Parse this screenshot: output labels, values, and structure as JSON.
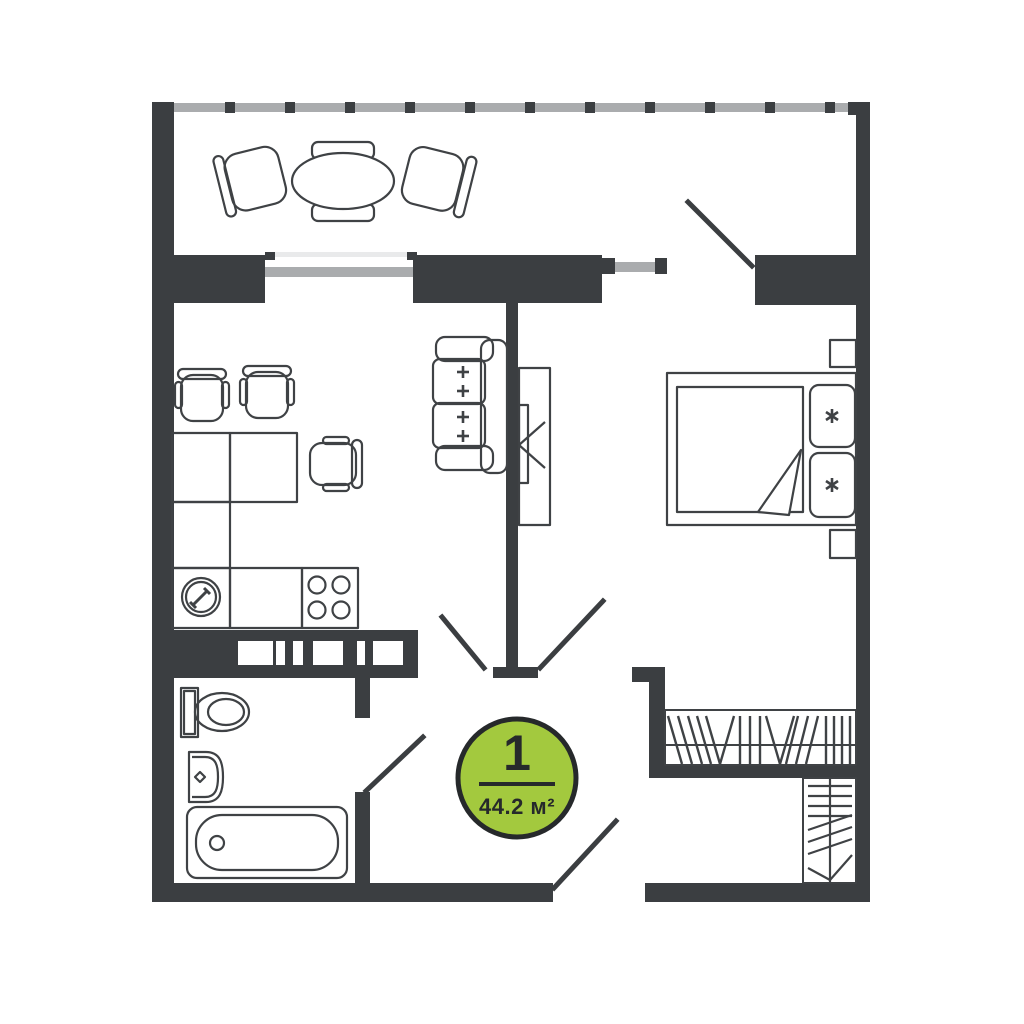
{
  "badge": {
    "number": "1",
    "area": "44.2 м²"
  },
  "colors": {
    "background": "#ffffff",
    "wall": "#3b3e41",
    "line": "#3f4245",
    "glazing": "#aaacae",
    "sill": "#e9eaeb",
    "badge_fill": "#a3c93e",
    "badge_stroke": "#26292b",
    "badge_text": "#26292b"
  }
}
